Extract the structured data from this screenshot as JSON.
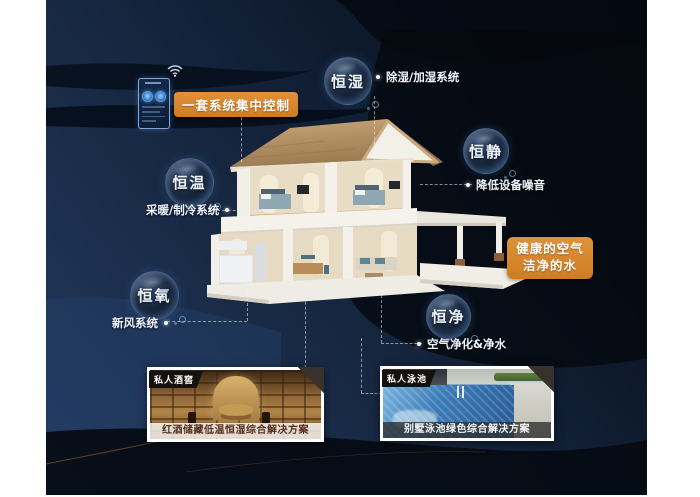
{
  "window": {
    "bg": "#ffffff",
    "canvas_navy": "#16263f"
  },
  "colors": {
    "accent_orange": "#d8862b",
    "bubble_text": "#eef4fc",
    "label_text": "#eef3fa"
  },
  "control_panel": {
    "label": "一套系统集中控制"
  },
  "features": [
    {
      "id": "humidity",
      "bubble": "恒湿",
      "note": "除湿/加湿系统"
    },
    {
      "id": "quiet",
      "bubble": "恒静",
      "note": "降低设备噪音"
    },
    {
      "id": "temperature",
      "bubble": "恒温",
      "note": "采暖/制冷系统"
    },
    {
      "id": "oxygen",
      "bubble": "恒氧",
      "note": "新风系统"
    },
    {
      "id": "purity",
      "bubble": "恒净",
      "note": "空气净化&净水"
    }
  ],
  "highlight": {
    "line1": "健康的空气",
    "line2": "洁净的水"
  },
  "cards": [
    {
      "tag": "私人酒窖",
      "caption": "红酒储藏低温恒湿综合解决方案"
    },
    {
      "tag": "私人泳池",
      "caption": "别墅泳池绿色综合解决方案"
    }
  ]
}
